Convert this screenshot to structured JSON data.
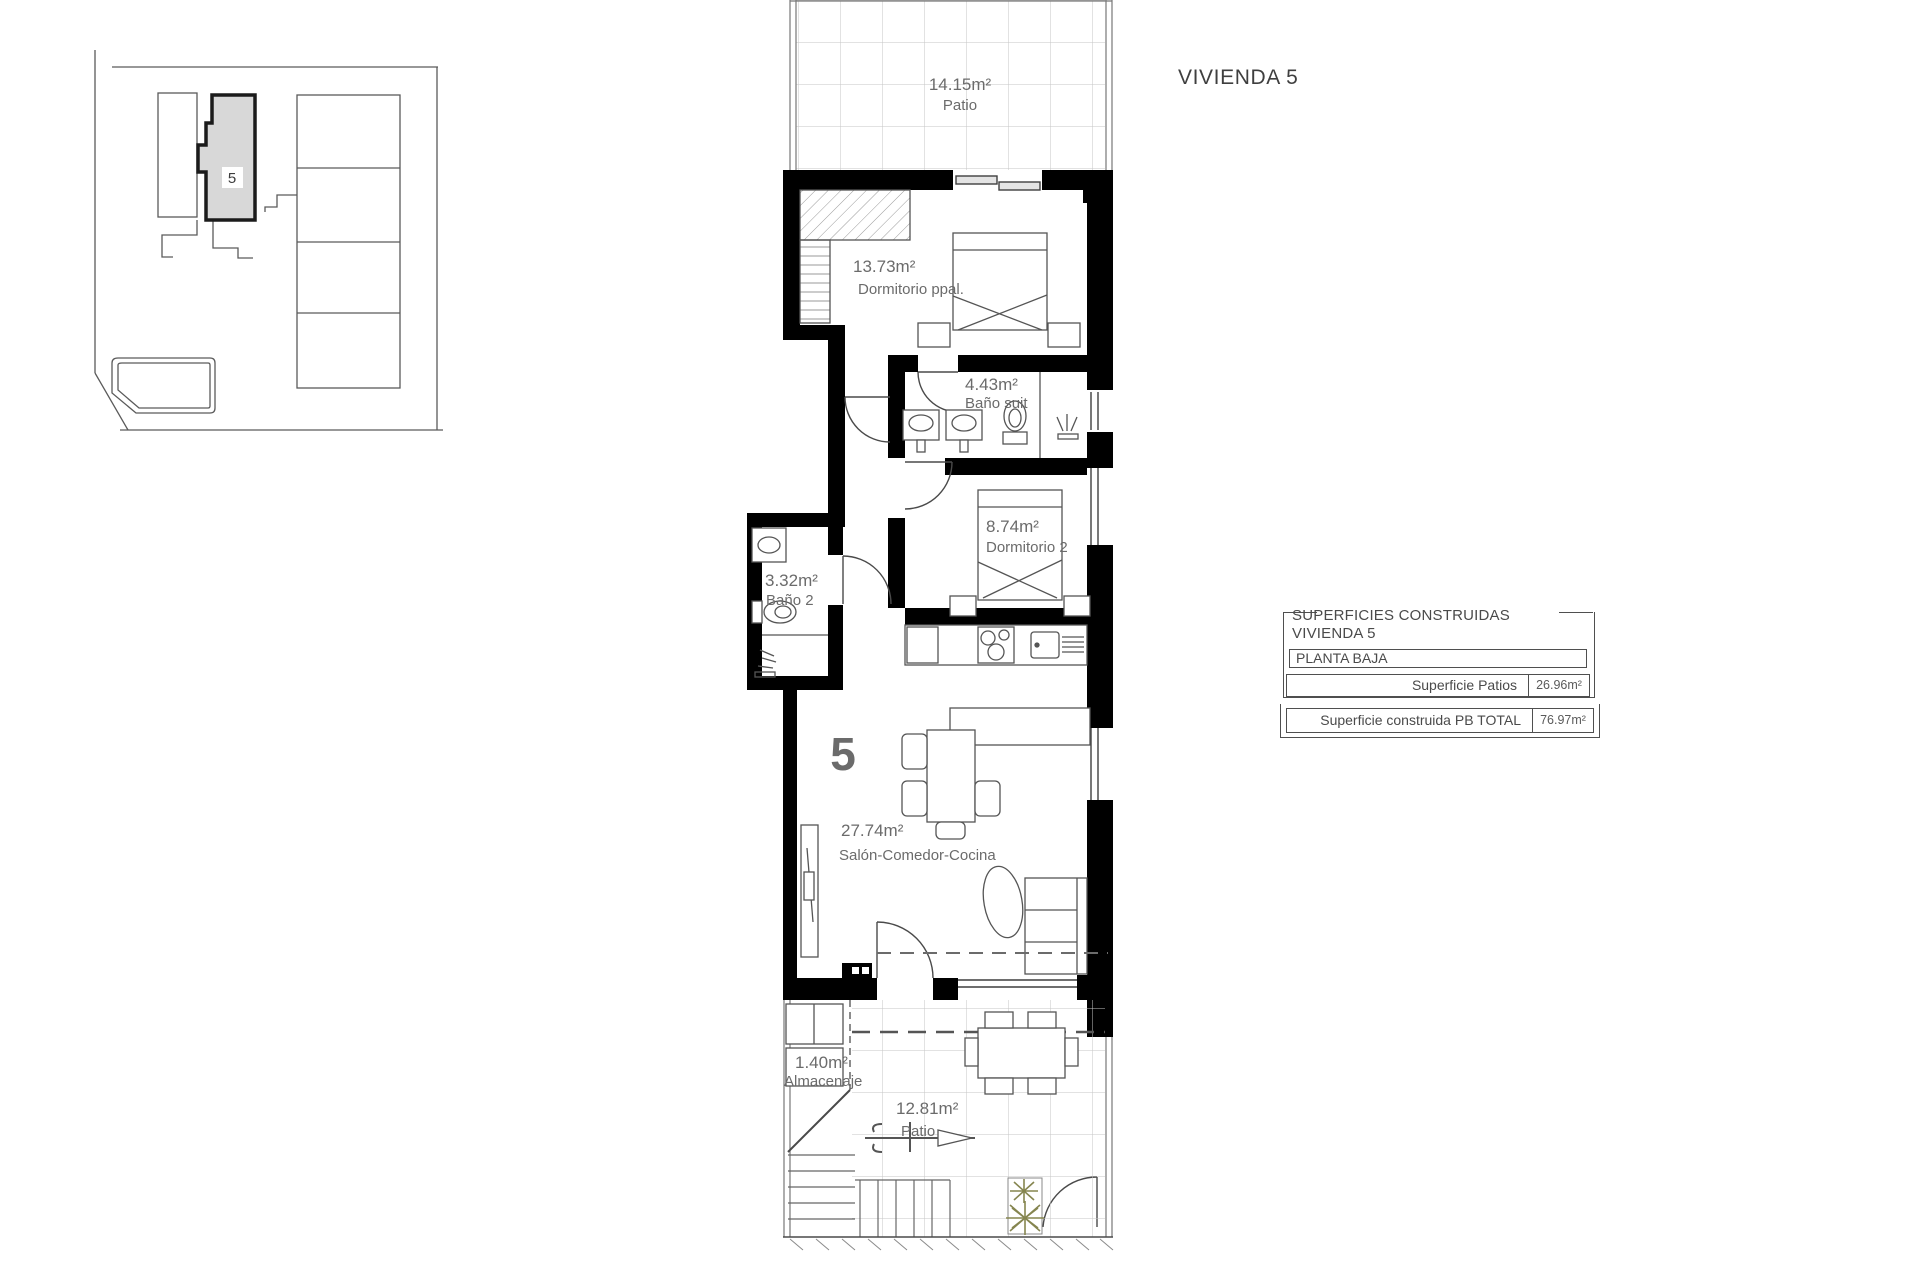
{
  "header": {
    "title": "VIVIENDA 5"
  },
  "floor_plan": {
    "unit_number": "5",
    "rooms": [
      {
        "area": "14.15m²",
        "name": "Patio"
      },
      {
        "area": "13.73m²",
        "name": "Dormitorio ppal."
      },
      {
        "area": "4.43m²",
        "name": "Baño suit"
      },
      {
        "area": "8.74m²",
        "name": "Dormitorio 2"
      },
      {
        "area": "3.32m²",
        "name": "Baño 2"
      },
      {
        "area": "27.74m²",
        "name": "Salón-Comedor-Cocina"
      },
      {
        "area": "1.40m²",
        "name": "Almacenaje"
      },
      {
        "area": "12.81m²",
        "name": "Patio"
      }
    ]
  },
  "site_plan": {
    "unit_label": "5"
  },
  "summary_table": {
    "title_line1": "SUPERFICIES CONSTRUIDAS",
    "title_line2": "VIVIENDA 5",
    "floor_label": "PLANTA BAJA",
    "rows": [
      {
        "label": "Superficie Patios",
        "value": "26.96m²"
      }
    ],
    "total": {
      "label": "Superficie construida PB TOTAL",
      "value": "76.97m²"
    }
  },
  "colors": {
    "accent": "#b42b4e",
    "wall": "#000000",
    "plant": "#85854f"
  }
}
